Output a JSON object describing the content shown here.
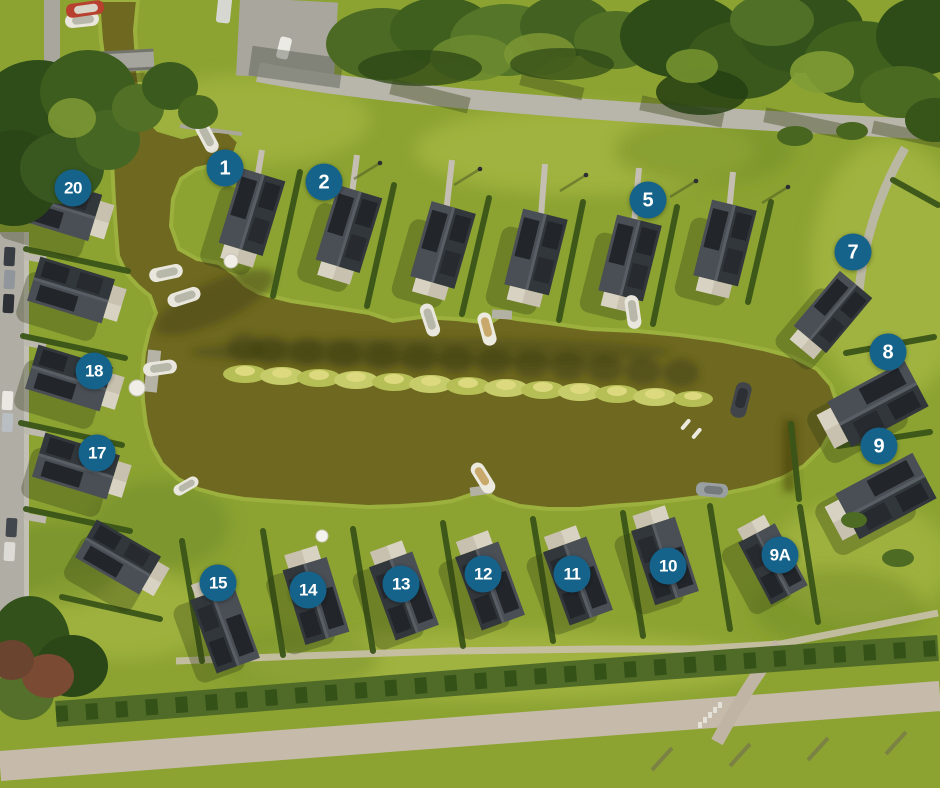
{
  "map": {
    "description": "Aerial view of waterside holiday park with numbered lots around a central canal"
  },
  "markers": [
    {
      "label": "1",
      "x": 225,
      "y": 168
    },
    {
      "label": "2",
      "x": 324,
      "y": 182
    },
    {
      "label": "5",
      "x": 648,
      "y": 200
    },
    {
      "label": "7",
      "x": 853,
      "y": 252
    },
    {
      "label": "8",
      "x": 888,
      "y": 352
    },
    {
      "label": "9",
      "x": 879,
      "y": 446
    },
    {
      "label": "9A",
      "x": 780,
      "y": 555
    },
    {
      "label": "10",
      "x": 668,
      "y": 566
    },
    {
      "label": "11",
      "x": 572,
      "y": 574
    },
    {
      "label": "12",
      "x": 483,
      "y": 574
    },
    {
      "label": "13",
      "x": 401,
      "y": 584
    },
    {
      "label": "14",
      "x": 308,
      "y": 590
    },
    {
      "label": "15",
      "x": 218,
      "y": 583
    },
    {
      "label": "17",
      "x": 97,
      "y": 453
    },
    {
      "label": "18",
      "x": 94,
      "y": 371
    },
    {
      "label": "20",
      "x": 73,
      "y": 188
    }
  ],
  "colors": {
    "marker_background": "#15638a",
    "marker_text": "#ffffff",
    "water": "#6e6820",
    "grass": "#8ca332",
    "roof_dark": "#32373c",
    "road": "#bdb6aa"
  }
}
